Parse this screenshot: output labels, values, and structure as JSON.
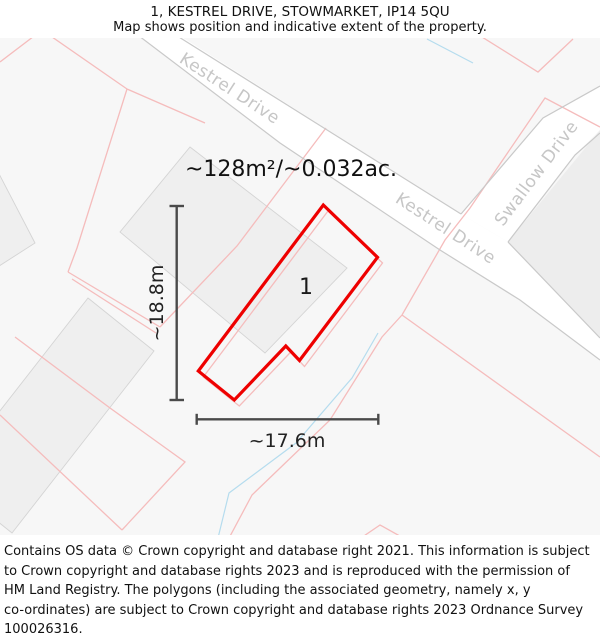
{
  "header": {
    "title": "1, KESTREL DRIVE, STOWMARKET, IP14 5QU",
    "subtitle": "Map shows position and indicative extent of the property."
  },
  "map": {
    "area_label": "~128m²/~0.032ac.",
    "plot_number": "1",
    "dim_height": "~18.8m",
    "dim_width": "~17.6m",
    "road_labels": {
      "kestrel_upper": "Kestrel Drive",
      "kestrel_lower": "Kestrel Drive",
      "swallow": "Swallow Drive"
    },
    "colors": {
      "property_outline": "#ee0000",
      "parcel_line": "#f5bcbc",
      "water_line": "#b5dcee",
      "road_edge": "#c9c9c9",
      "road_fill": "#ffffff",
      "road_label": "#c6c6c6",
      "building_fill": "#efefef",
      "building_stroke": "#d4d4d4",
      "map_background": "#f7f7f7",
      "dimension_line": "#4a4a4a"
    }
  },
  "footer": {
    "lines": [
      "Contains OS data © Crown copyright and database right 2021. This information is subject",
      "to Crown copyright and database rights 2023 and is reproduced with the permission of",
      "HM Land Registry. The polygons (including the associated geometry, namely x, y",
      "co-ordinates) are subject to Crown copyright and database rights 2023 Ordnance Survey",
      "100026316."
    ]
  }
}
